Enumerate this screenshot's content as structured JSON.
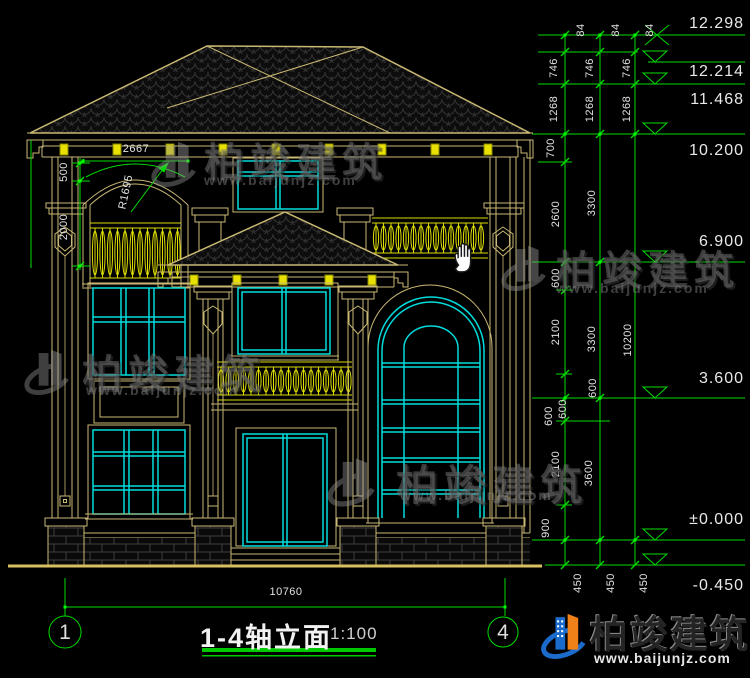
{
  "title": {
    "main": "1-4轴立面",
    "scale": "1:100"
  },
  "axis_bubbles": {
    "left": "1",
    "right": "4"
  },
  "bottom_dim": "10760",
  "dim_labels": [
    {
      "t": "84",
      "x": 581,
      "y": 30,
      "r": -90
    },
    {
      "t": "84",
      "x": 616,
      "y": 30,
      "r": -90
    },
    {
      "t": "84",
      "x": 650,
      "y": 30,
      "r": -90
    },
    {
      "t": "746",
      "x": 554,
      "y": 68,
      "r": -90
    },
    {
      "t": "746",
      "x": 590,
      "y": 68,
      "r": -90
    },
    {
      "t": "746",
      "x": 627,
      "y": 68,
      "r": -90
    },
    {
      "t": "1268",
      "x": 554,
      "y": 109,
      "r": -90
    },
    {
      "t": "1268",
      "x": 590,
      "y": 109,
      "r": -90
    },
    {
      "t": "1268",
      "x": 627,
      "y": 109,
      "r": -90
    },
    {
      "t": "700",
      "x": 551,
      "y": 148,
      "r": -90
    },
    {
      "t": "2600",
      "x": 556,
      "y": 214,
      "r": -90
    },
    {
      "t": "3300",
      "x": 592,
      "y": 203,
      "r": -90
    },
    {
      "t": "600",
      "x": 556,
      "y": 278,
      "r": -90
    },
    {
      "t": "2100",
      "x": 556,
      "y": 332,
      "r": -90
    },
    {
      "t": "3300",
      "x": 592,
      "y": 339,
      "r": -90
    },
    {
      "t": "10200",
      "x": 628,
      "y": 340,
      "r": -90
    },
    {
      "t": "600",
      "x": 549,
      "y": 416,
      "r": -90
    },
    {
      "t": "600",
      "x": 563,
      "y": 409,
      "r": -90
    },
    {
      "t": "600",
      "x": 593,
      "y": 388,
      "r": -90
    },
    {
      "t": "2100",
      "x": 556,
      "y": 464,
      "r": -90
    },
    {
      "t": "3600",
      "x": 589,
      "y": 473,
      "r": -90
    },
    {
      "t": "900",
      "x": 546,
      "y": 528,
      "r": -90
    },
    {
      "t": "450",
      "x": 578,
      "y": 583,
      "r": -90
    },
    {
      "t": "450",
      "x": 611,
      "y": 583,
      "r": -90
    },
    {
      "t": "450",
      "x": 644,
      "y": 583,
      "r": -90
    },
    {
      "t": "500",
      "x": 64,
      "y": 172,
      "r": -90
    },
    {
      "t": "2000",
      "x": 64,
      "y": 227,
      "r": -90
    },
    {
      "t": "2667",
      "x": 136,
      "y": 149,
      "r": 0
    },
    {
      "t": "R1695",
      "x": 126,
      "y": 192,
      "r": -78
    },
    {
      "t": "10760",
      "x": 286,
      "y": 592,
      "r": 0
    }
  ],
  "elevation_marks": [
    {
      "text": "12.298",
      "top": 15
    },
    {
      "text": "12.214",
      "top": 63
    },
    {
      "text": "11.468",
      "top": 91
    },
    {
      "text": "10.200",
      "top": 142
    },
    {
      "text": "6.900",
      "top": 233
    },
    {
      "text": "3.600",
      "top": 370
    },
    {
      "text": "±0.000",
      "top": 511
    },
    {
      "text": "-0.450",
      "top": 577
    }
  ],
  "watermarks": [
    {
      "cn": "柏竣建筑",
      "url": "www.baijunjz.com"
    },
    {
      "cn": "柏竣建筑",
      "url": "www.baijunjz.com"
    },
    {
      "cn": "柏竣建筑",
      "url": "www.baijunjz.com"
    },
    {
      "cn": "柏竣建筑",
      "url": "www.baijunjz.com"
    }
  ],
  "brand": {
    "cn": "柏竣建筑",
    "url": "www.baijunjz.com"
  },
  "colors": {
    "line_tan": "#C9B873",
    "window_cyan": "#00DCDC",
    "dim_green": "#00DC00",
    "baluster_yellow": "#DCDC00",
    "block_yellow": "#E8E000",
    "dim_text": "#E2E2E2",
    "brand_blue": "#1A6BCC",
    "brand_orange": "#F08018"
  },
  "cursor": {
    "type": "hand"
  }
}
